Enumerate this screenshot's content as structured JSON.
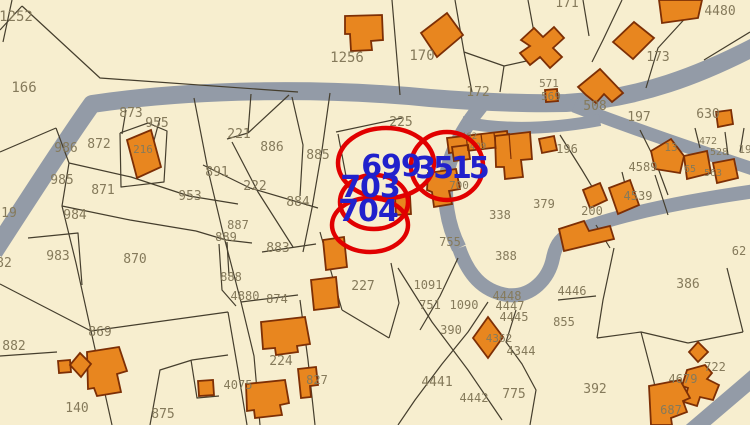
{
  "map": {
    "background": "#f7eecf",
    "road_color": "#939ba7",
    "line_color": "#453e2d",
    "building_fill": "#e8861f",
    "building_stroke": "#7d2f05",
    "label_color": "#857a5b",
    "highlight_color": "#2121cc",
    "circle_color": "#e10000"
  },
  "highlight_labels": [
    {
      "text": "699",
      "x": 391,
      "y": 176,
      "size": 30,
      "ls": -1
    },
    {
      "text": "3515",
      "x": 451,
      "y": 178,
      "size": 30,
      "ls": -3
    },
    {
      "text": "703",
      "x": 370,
      "y": 197,
      "size": 30,
      "ls": -1
    },
    {
      "text": "704",
      "x": 368,
      "y": 221,
      "size": 30,
      "ls": -1
    }
  ],
  "circles": [
    {
      "cx": 386,
      "cy": 163,
      "rx": 48,
      "ry": 35
    },
    {
      "cx": 447,
      "cy": 166,
      "rx": 36,
      "ry": 34
    },
    {
      "cx": 374,
      "cy": 202,
      "rx": 34,
      "ry": 27
    },
    {
      "cx": 370,
      "cy": 225,
      "rx": 38,
      "ry": 27
    }
  ],
  "parcel_labels": [
    {
      "t": "1252",
      "x": 16,
      "y": 21,
      "s": 14
    },
    {
      "t": "166",
      "x": 24,
      "y": 92,
      "s": 14
    },
    {
      "t": "873",
      "x": 131,
      "y": 117,
      "s": 13
    },
    {
      "t": "955",
      "x": 157,
      "y": 127,
      "s": 13
    },
    {
      "t": "872",
      "x": 99,
      "y": 148,
      "s": 13
    },
    {
      "t": "986",
      "x": 66,
      "y": 152,
      "s": 13
    },
    {
      "t": "216",
      "x": 143,
      "y": 153,
      "s": 11
    },
    {
      "t": "985",
      "x": 62,
      "y": 184,
      "s": 13
    },
    {
      "t": "871",
      "x": 103,
      "y": 194,
      "s": 13
    },
    {
      "t": "19",
      "x": 9,
      "y": 217,
      "s": 13
    },
    {
      "t": "953",
      "x": 190,
      "y": 200,
      "s": 13
    },
    {
      "t": "984",
      "x": 75,
      "y": 219,
      "s": 13
    },
    {
      "t": "983",
      "x": 58,
      "y": 260,
      "s": 13
    },
    {
      "t": "870",
      "x": 135,
      "y": 263,
      "s": 13
    },
    {
      "t": "82",
      "x": 4,
      "y": 267,
      "s": 13
    },
    {
      "t": "869",
      "x": 100,
      "y": 336,
      "s": 13
    },
    {
      "t": "882",
      "x": 14,
      "y": 350,
      "s": 13
    },
    {
      "t": "140",
      "x": 77,
      "y": 412,
      "s": 13
    },
    {
      "t": "875",
      "x": 163,
      "y": 418,
      "s": 13
    },
    {
      "t": "4075",
      "x": 238,
      "y": 389,
      "s": 12
    },
    {
      "t": "221",
      "x": 239,
      "y": 138,
      "s": 13
    },
    {
      "t": "886",
      "x": 272,
      "y": 151,
      "s": 13
    },
    {
      "t": "885",
      "x": 318,
      "y": 159,
      "s": 13
    },
    {
      "t": "891",
      "x": 217,
      "y": 176,
      "s": 13
    },
    {
      "t": "222",
      "x": 255,
      "y": 190,
      "s": 13
    },
    {
      "t": "884",
      "x": 298,
      "y": 206,
      "s": 13
    },
    {
      "t": "887",
      "x": 238,
      "y": 229,
      "s": 12
    },
    {
      "t": "889",
      "x": 226,
      "y": 241,
      "s": 12
    },
    {
      "t": "883",
      "x": 278,
      "y": 252,
      "s": 13
    },
    {
      "t": "888",
      "x": 231,
      "y": 281,
      "s": 12
    },
    {
      "t": "4880",
      "x": 245,
      "y": 300,
      "s": 12
    },
    {
      "t": "874",
      "x": 277,
      "y": 303,
      "s": 12
    },
    {
      "t": "224",
      "x": 281,
      "y": 365,
      "s": 13
    },
    {
      "t": "827",
      "x": 317,
      "y": 384,
      "s": 12
    },
    {
      "t": "227",
      "x": 363,
      "y": 290,
      "s": 13
    },
    {
      "t": "1256",
      "x": 347,
      "y": 62,
      "s": 14
    },
    {
      "t": "170",
      "x": 422,
      "y": 60,
      "s": 14
    },
    {
      "t": "172",
      "x": 478,
      "y": 96,
      "s": 13
    },
    {
      "t": "225",
      "x": 401,
      "y": 126,
      "s": 13
    },
    {
      "t": "171",
      "x": 567,
      "y": 7,
      "s": 13
    },
    {
      "t": "4480",
      "x": 720,
      "y": 15,
      "s": 13
    },
    {
      "t": "173",
      "x": 658,
      "y": 61,
      "s": 13
    },
    {
      "t": "571",
      "x": 549,
      "y": 87,
      "s": 11
    },
    {
      "t": "569",
      "x": 551,
      "y": 100,
      "s": 11
    },
    {
      "t": "508",
      "x": 595,
      "y": 110,
      "s": 13
    },
    {
      "t": "197",
      "x": 639,
      "y": 121,
      "s": 13
    },
    {
      "t": "630",
      "x": 708,
      "y": 118,
      "s": 13
    },
    {
      "t": "462",
      "x": 469,
      "y": 139,
      "s": 9
    },
    {
      "t": "409",
      "x": 478,
      "y": 149,
      "s": 9
    },
    {
      "t": "196",
      "x": 567,
      "y": 153,
      "s": 12
    },
    {
      "t": "13",
      "x": 671,
      "y": 151,
      "s": 11
    },
    {
      "t": "472",
      "x": 708,
      "y": 144,
      "s": 10
    },
    {
      "t": "528",
      "x": 719,
      "y": 155,
      "s": 10
    },
    {
      "t": "19",
      "x": 745,
      "y": 153,
      "s": 11
    },
    {
      "t": "65",
      "x": 690,
      "y": 172,
      "s": 10
    },
    {
      "t": "563",
      "x": 713,
      "y": 176,
      "s": 10
    },
    {
      "t": "4589",
      "x": 643,
      "y": 171,
      "s": 12
    },
    {
      "t": "4539",
      "x": 638,
      "y": 200,
      "s": 12
    },
    {
      "t": "700",
      "x": 459,
      "y": 189,
      "s": 11
    },
    {
      "t": "338",
      "x": 500,
      "y": 219,
      "s": 12
    },
    {
      "t": "379",
      "x": 544,
      "y": 208,
      "s": 12
    },
    {
      "t": "200",
      "x": 592,
      "y": 215,
      "s": 12
    },
    {
      "t": "755",
      "x": 450,
      "y": 246,
      "s": 12
    },
    {
      "t": "388",
      "x": 506,
      "y": 260,
      "s": 12
    },
    {
      "t": "4446",
      "x": 572,
      "y": 295,
      "s": 12
    },
    {
      "t": "855",
      "x": 564,
      "y": 326,
      "s": 12
    },
    {
      "t": "386",
      "x": 688,
      "y": 288,
      "s": 13
    },
    {
      "t": "1091",
      "x": 428,
      "y": 289,
      "s": 12
    },
    {
      "t": "751",
      "x": 430,
      "y": 309,
      "s": 12
    },
    {
      "t": "1090",
      "x": 464,
      "y": 309,
      "s": 12
    },
    {
      "t": "4448",
      "x": 507,
      "y": 300,
      "s": 12
    },
    {
      "t": "4447",
      "x": 510,
      "y": 310,
      "s": 12
    },
    {
      "t": "4445",
      "x": 514,
      "y": 321,
      "s": 12
    },
    {
      "t": "390",
      "x": 451,
      "y": 334,
      "s": 12
    },
    {
      "t": "4362",
      "x": 499,
      "y": 342,
      "s": 11
    },
    {
      "t": "4344",
      "x": 521,
      "y": 355,
      "s": 12
    },
    {
      "t": "4441",
      "x": 437,
      "y": 386,
      "s": 13
    },
    {
      "t": "4442",
      "x": 474,
      "y": 402,
      "s": 12
    },
    {
      "t": "775",
      "x": 514,
      "y": 398,
      "s": 13
    },
    {
      "t": "392",
      "x": 595,
      "y": 393,
      "s": 13
    },
    {
      "t": "4679",
      "x": 683,
      "y": 383,
      "s": 12
    },
    {
      "t": "722",
      "x": 715,
      "y": 371,
      "s": 12
    },
    {
      "t": "687",
      "x": 671,
      "y": 414,
      "s": 12
    },
    {
      "t": "62",
      "x": 739,
      "y": 255,
      "s": 12
    }
  ],
  "roads": [
    {
      "d": "M-6,252 C20,212 62,146 92,104 C200,88 330,88 430,98 C480,102 522,104 566,103 C640,99 702,74 756,46",
      "w": 18
    },
    {
      "d": "M481,106 C466,124 452,148 447,173 C443,196 447,224 459,248",
      "w": 15
    },
    {
      "d": "M459,248 C468,274 482,291 507,295 C532,298 549,278 553,258 C556,243 562,237 574,232 C622,213 692,200 756,191",
      "w": 14
    },
    {
      "d": "M690,432 L758,374",
      "w": 16
    },
    {
      "d": "M574,106 C620,124 690,148 756,170",
      "w": 13
    },
    {
      "d": "M462,122 C505,131 552,129 600,120",
      "w": 12
    }
  ],
  "parcel_lines": [
    "22,6 100,78 298,92",
    "12,0 3,42",
    "0,30 22,6",
    "56,128 0,152",
    "56,128 69,163 62,206 76,263 91,331 112,425",
    "69,163 131,177 189,196 238,204",
    "62,206 130,220 196,231",
    "126,110 122,134",
    "160,118 152,148",
    "120,133 148,123 167,131 164,182 121,187 120,133",
    "194,98 208,170 223,233 241,302 254,356 260,425",
    "251,94 248,133",
    "248,133 289,95",
    "248,133 227,139",
    "292,97 303,145 300,196",
    "232,142 258,192 293,247",
    "203,165 250,188 318,208",
    "330,93 322,150 312,208 303,252",
    "196,231 226,240 252,243",
    "227,242 229,276",
    "219,244 222,290 236,306",
    "241,302 298,295",
    "300,300 308,360 315,425",
    "228,312 238,370 247,425",
    "192,360 228,355",
    "191,360 197,398 219,396",
    "0,284 91,331",
    "91,331 228,312",
    "0,356 57,352",
    "150,425 160,370 192,360",
    "28,238 78,233 82,285",
    "392,0 400,95",
    "455,0 464,52 472,92",
    "464,52 504,66 540,58",
    "504,66 500,92",
    "528,0 535,38",
    "583,0 589,36",
    "622,0 603,40 592,62",
    "702,0 658,48 646,88",
    "750,32 704,60",
    "560,135 582,170 600,200",
    "640,130 655,160 668,195",
    "695,128 700,148",
    "725,132 728,155",
    "744,128 740,152",
    "622,172 630,204",
    "655,175 668,215",
    "596,225 610,248",
    "614,248 603,300 597,338",
    "597,338 641,332 688,343",
    "727,268 743,332",
    "641,332 654,382 662,425",
    "558,300 596,296",
    "688,343 743,332",
    "398,268 432,322 468,370 502,420",
    "488,302 468,332 442,364 415,400 398,425",
    "458,258 440,296 420,330",
    "516,310 506,342 522,364 536,390 530,425",
    "391,263 399,303 389,338",
    "320,232 332,275 342,310",
    "342,310 389,338",
    "336,132 402,118",
    "338,134 346,176",
    "262,252 316,244"
  ],
  "buildings": [
    {
      "d": "M345,16 L382,15 L383,40 L371,41 L372,50 L351,51 L350,34 L345,34 Z"
    },
    {
      "d": "M421,33 L447,13 L463,35 L437,57 Z"
    },
    {
      "d": "M659,0 L702,0 L698,18 L662,23 Z"
    },
    {
      "d": "M613,42 L634,22 L654,38 L633,59 Z"
    },
    {
      "d": "M521,40 L534,28 L543,37 L554,27 L564,38 L553,48 L562,57 L550,68 L540,57 L530,65 L520,53 L530,46 Z"
    },
    {
      "d": "M545,90 L557,89 L558,101 L546,102 Z"
    },
    {
      "d": "M578,87 L600,69 L623,93 L612,102 L604,94 L596,103 L586,95 Z"
    },
    {
      "d": "M716,112 L731,110 L733,124 L718,127 Z"
    },
    {
      "d": "M651,151 L671,139 L684,156 L680,173 L655,169 Z"
    },
    {
      "d": "M684,156 L707,151 L711,173 L687,179 Z"
    },
    {
      "d": "M713,163 L734,159 L738,178 L717,183 Z"
    },
    {
      "d": "M447,138 L507,131 L509,146 L449,153 Z"
    },
    {
      "d": "M452,147 L468,145 L470,159 L454,161 Z"
    },
    {
      "d": "M495,136 L530,132 L532,159 L521,160 L523,177 L505,179 L504,167 L496,167 Z"
    },
    {
      "d": "M539,139 L554,136 L557,150 L542,153 Z"
    },
    {
      "d": "M428,173 L456,169 L460,189 L449,191 L452,204 L434,207 L432,192 L427,190 Z"
    },
    {
      "d": "M395,197 L410,196 L411,214 L396,215 Z"
    },
    {
      "d": "M127,140 L151,130 L161,167 L137,178 Z"
    },
    {
      "d": "M323,240 L344,237 L347,267 L326,270 Z"
    },
    {
      "d": "M311,280 L336,277 L339,307 L314,310 Z"
    },
    {
      "d": "M261,322 L305,317 L310,344 L297,346 L298,352 L276,355 L275,348 L263,349 Z"
    },
    {
      "d": "M298,369 L316,367 L318,385 L310,386 L311,397 L301,398 Z"
    },
    {
      "d": "M246,384 L285,380 L289,403 L280,405 L282,415 L255,418 L254,410 L247,411 Z"
    },
    {
      "d": "M198,381 L213,380 L214,395 L199,396 Z"
    },
    {
      "d": "M87,352 L119,347 L127,371 L117,374 L121,392 L97,396 L94,388 L88,389 Z"
    },
    {
      "d": "M58,361 L70,360 L71,372 L59,373 Z"
    },
    {
      "d": "M70,365 L80,353 L91,364 L81,377 Z"
    },
    {
      "d": "M473,338 L488,317 L503,337 L488,358 Z"
    },
    {
      "d": "M689,352 L698,342 L708,352 L698,362 Z"
    },
    {
      "d": "M687,370 L705,365 L712,373 L707,379 L719,385 L713,400 L700,397 L697,406 L684,402 L688,388 L682,386 Z"
    },
    {
      "d": "M649,386 L680,380 L690,398 L683,401 L687,412 L671,418 L672,425 L651,425 Z"
    },
    {
      "d": "M583,190 L600,183 L607,200 L590,208 Z"
    },
    {
      "d": "M609,188 L630,180 L639,205 L618,214 Z"
    },
    {
      "d": "M559,229 L584,221 L589,231 L610,226 L614,239 L564,251 Z"
    }
  ],
  "building_overlines": [
    "466,135 468,151",
    "481,134 483,150",
    "494,133 496,149",
    "509,133 511,159"
  ]
}
